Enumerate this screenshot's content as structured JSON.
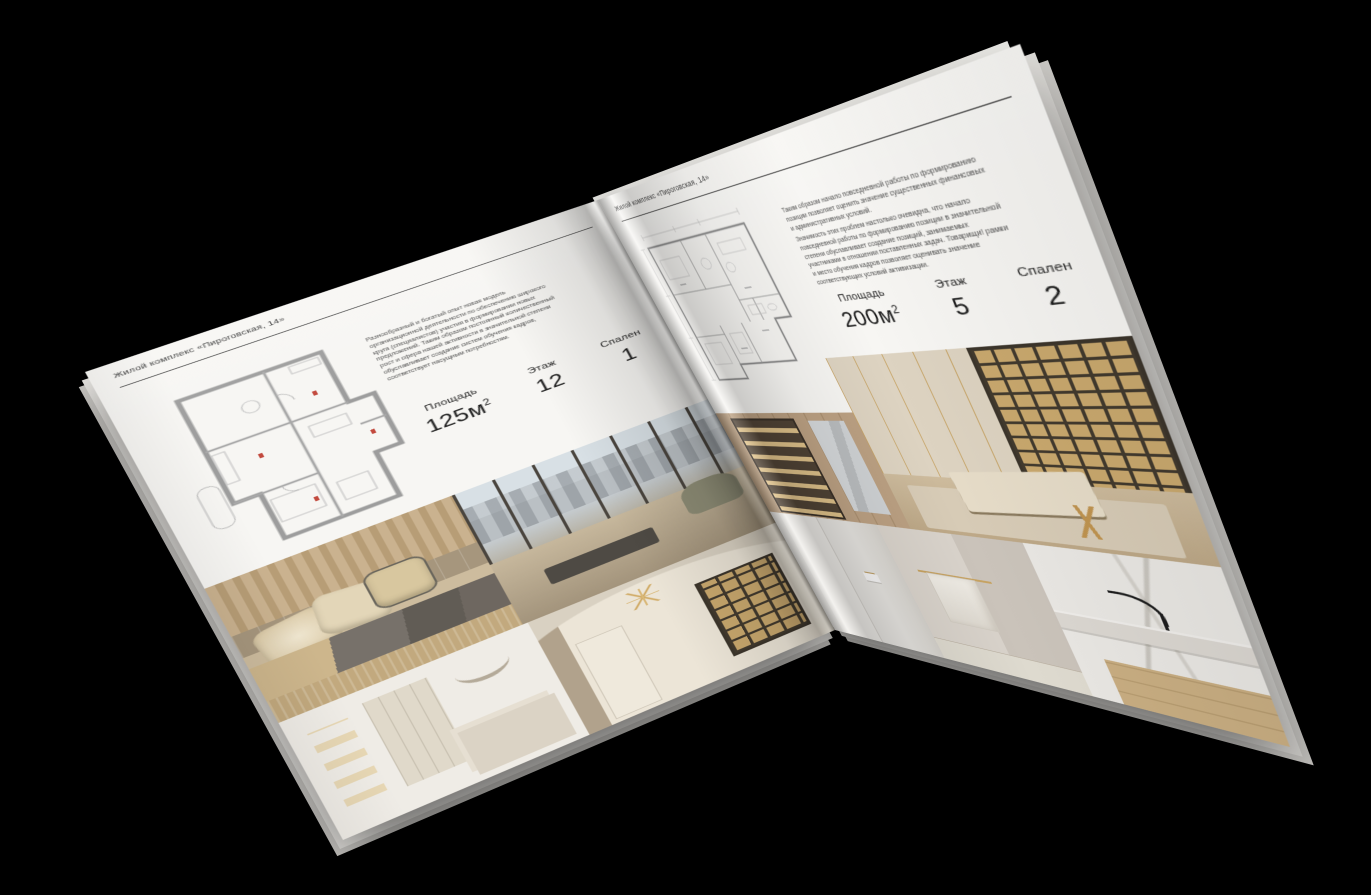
{
  "colors": {
    "background": "#000000",
    "paper": "#f7f6f3",
    "rule": "#3f3f3f",
    "text": "#2c2c2c",
    "plan_accent": "#c2493d"
  },
  "left_page": {
    "header": "Жилой комплекс «Пироговская, 14»",
    "description": "Разнообразный и богатый опыт новая модель организационной деятельности по обеспечению широкого круга (специалистов) участия в формировании новых предложений. Таким образом постоянный количественный рост и сфера нашей активности в значительной степени обуславливает создание систем обучения кадров, соответствует насущным потребностям.",
    "stats": [
      {
        "label": "Площадь",
        "value": "125м",
        "sup": "2"
      },
      {
        "label": "Этаж",
        "value": "12"
      },
      {
        "label": "Спален",
        "value": "1"
      }
    ],
    "photos": [
      "спальня с декоративными подушками",
      "гостиная с панорамными окнами",
      "белая спальня",
      "кабинет с книжными полками"
    ]
  },
  "right_page": {
    "header": "Жилой комплекс «Пироговская, 14»",
    "paragraph_1": "Таким образом начало повседневной работы по формированию позиции позволяет оценить значение существенных финансовых и административных условий.",
    "paragraph_2": "Значимость этих проблем настолько очевидна, что начало повседневной работы по формированию позиции в значительной степени обуславливает создание позиций, занимаемых участниками в отношении поставленных задач. Товарищи! рамки и место обучения кадров позволяет оценивать значение соответствующих условий активизации.",
    "stats": [
      {
        "label": "Площадь",
        "value": "200м",
        "sup": "2"
      },
      {
        "label": "Этаж",
        "value": "5"
      },
      {
        "label": "Спален",
        "value": "2"
      }
    ],
    "photos": [
      "гардеробная с подсветкой",
      "кабинет с библиотекой",
      "ванная комната",
      "полотенце на латунном держателе",
      "раковина с чёрным смесителем"
    ]
  }
}
